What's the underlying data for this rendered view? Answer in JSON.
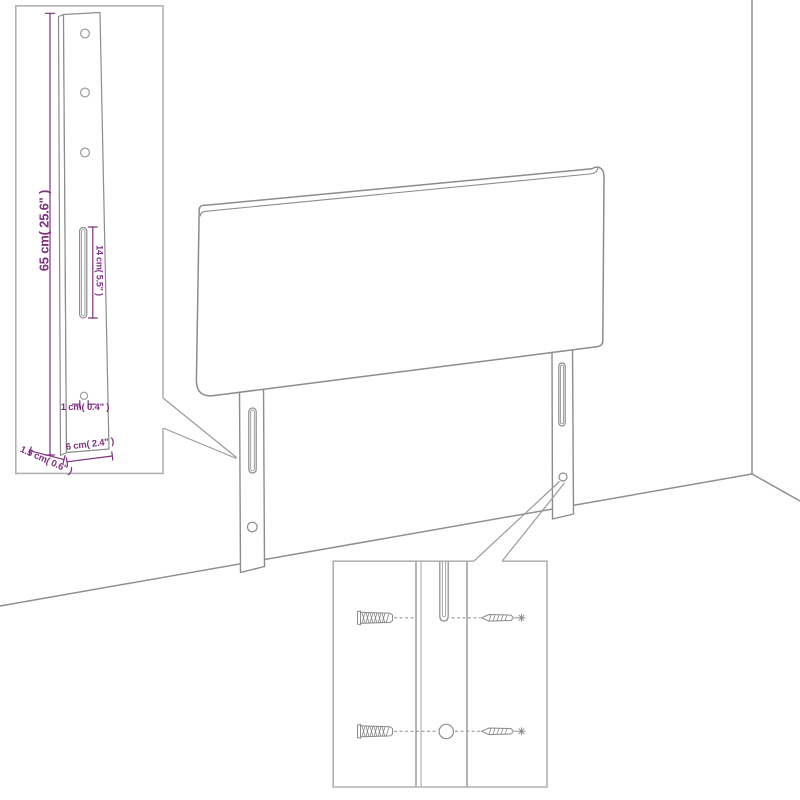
{
  "colors": {
    "dimension_text": "#7e2f80",
    "drawing_line": "#8c8c8c",
    "inset_border": "#b2b2b2",
    "background": "#ffffff"
  },
  "diagram": {
    "dimensions": {
      "leg_height": "65 cm( 25.6\" )",
      "slot_length": "14 cm( 5.5\" )",
      "hole_diameter": "1 cm( 0.4\" )",
      "leg_width": "6 cm( 2.4\" )",
      "leg_side_depth": "1.5 cm( 0.6\" )"
    }
  }
}
